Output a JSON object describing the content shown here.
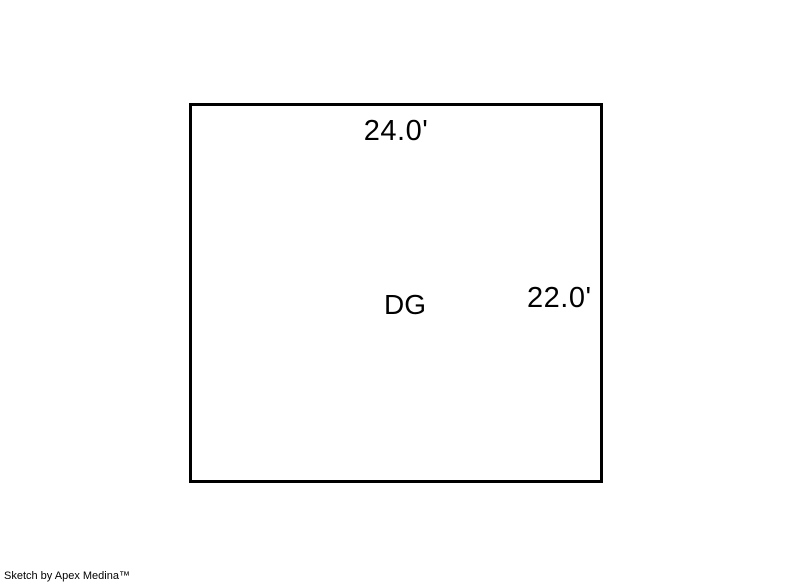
{
  "sketch": {
    "structure_label": "DG",
    "top_dimension": "24.0'",
    "right_dimension": "22.0'"
  },
  "footer": {
    "credit": "Sketch by Apex Medina™"
  },
  "colors": {
    "background": "#ffffff",
    "outline": "#000000",
    "text": "#000000"
  }
}
